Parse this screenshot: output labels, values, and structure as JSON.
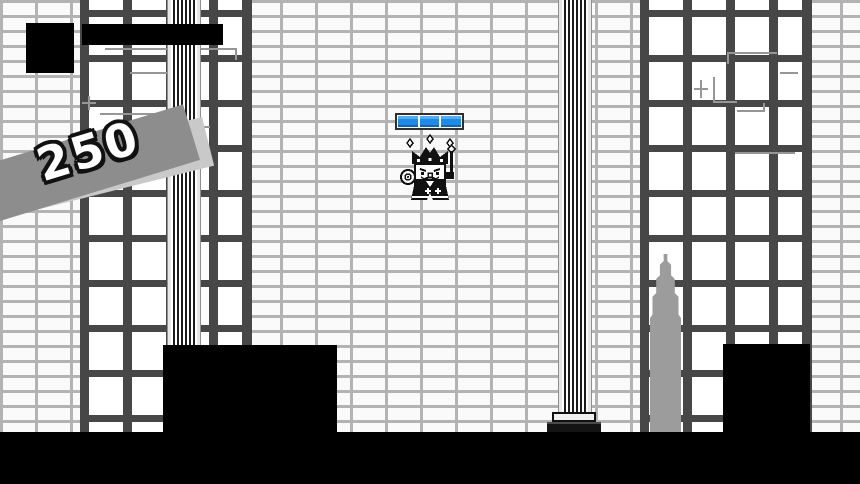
{
  "hud": {
    "score_banner": {
      "text": "250"
    },
    "portrait_icon": "player-portrait",
    "health_bar": {
      "fill": "full"
    }
  },
  "boss": {
    "sprite_icon": "king-boss",
    "health_bar": {
      "segments": 3
    }
  },
  "colors": {
    "mortar": "#b3b3b3",
    "window_frame": "#474747",
    "spike": "#9c9c9c",
    "banner_band": "#8d8d8d",
    "banner_shadow": "#c9c9c9",
    "boss_bar_blue": "#1d8ce8"
  }
}
